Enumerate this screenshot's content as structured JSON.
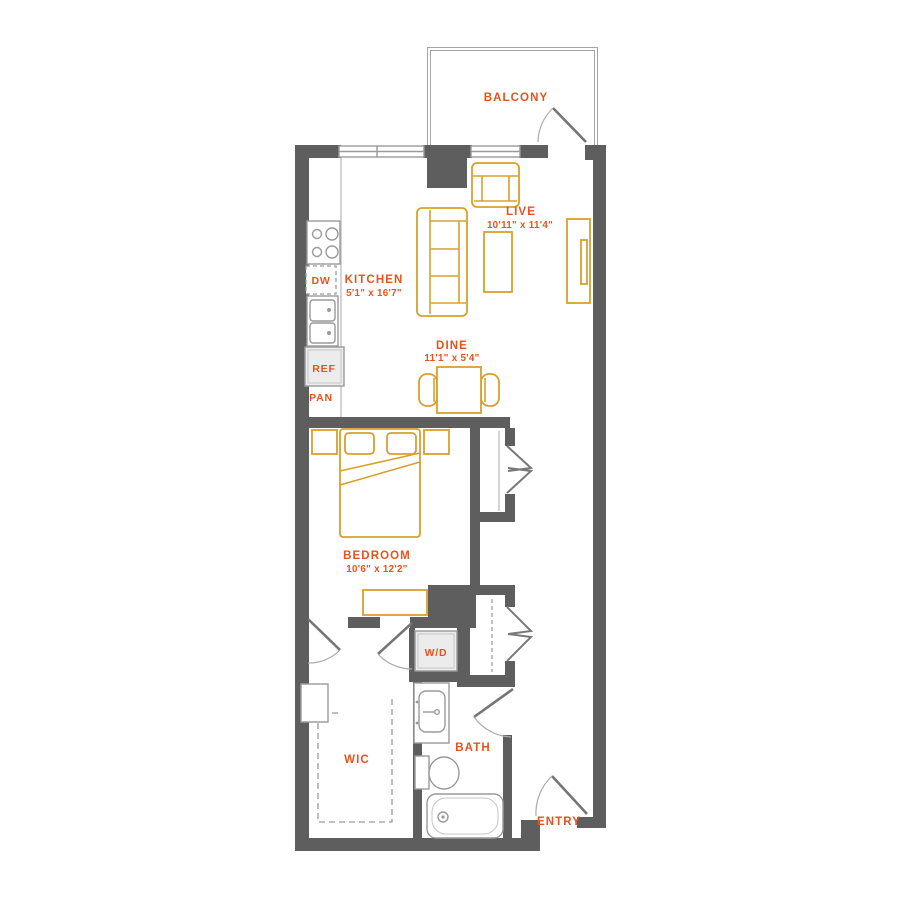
{
  "colors": {
    "wall": "#5e5e5e",
    "fixture": "#9a9a9a",
    "furniture": "#d8a02b",
    "accent": "#e5531f",
    "appliance_fill": "#ececec",
    "background": "#ffffff"
  },
  "rooms": {
    "balcony": {
      "label": "BALCONY"
    },
    "live": {
      "label": "LIVE",
      "dims": "10'11\" x 11'4\""
    },
    "kitchen": {
      "label": "KITCHEN",
      "dims": "5'1\" x 16'7\""
    },
    "dine": {
      "label": "DINE",
      "dims": "11'1\" x 5'4\""
    },
    "bedroom": {
      "label": "BEDROOM",
      "dims": "10'6\" x 12'2\""
    },
    "wic": {
      "label": "WIC"
    },
    "bath": {
      "label": "BATH"
    },
    "entry": {
      "label": "ENTRY"
    }
  },
  "appliances": {
    "dishwasher": "DW",
    "refrigerator": "REF",
    "pantry": "PAN",
    "washer_dryer": "W/D"
  }
}
